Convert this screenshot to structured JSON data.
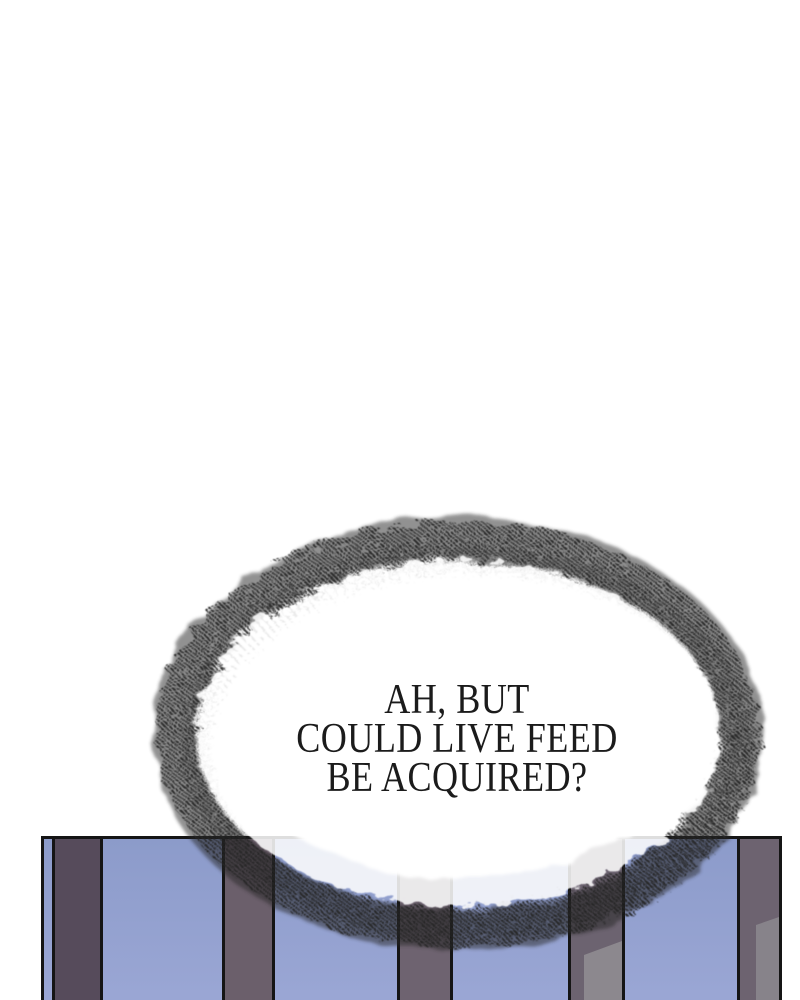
{
  "page": {
    "background": "#ffffff"
  },
  "speech_bubble": {
    "lines": [
      "AH, BUT",
      "COULD LIVE FEED",
      "BE ACQUIRED?"
    ],
    "text_color": "#1b1b1b",
    "fill_color": "#ffffff",
    "edge_color": "#262626"
  },
  "scene": {
    "border_color": "#151515",
    "sky_top_color": "#8c9bca",
    "sky_bottom_color": "#9ba7d5",
    "pillars": [
      {
        "left": 8,
        "width": 51,
        "color": "#564b5b"
      },
      {
        "left": 178,
        "width": 53,
        "color": "#6b5f6b"
      },
      {
        "left": 353,
        "width": 56,
        "color": "#6e6370"
      },
      {
        "left": 524,
        "width": 57,
        "color": "#6c6370",
        "highlight": {
          "left": 13,
          "top": 102,
          "slant": 14,
          "color": "#8c888e"
        }
      },
      {
        "left": 693,
        "width": 45,
        "color": "#6d6370",
        "highlight": {
          "left": 16,
          "top": 78,
          "slant": 8,
          "color": "#87838a"
        }
      }
    ]
  }
}
